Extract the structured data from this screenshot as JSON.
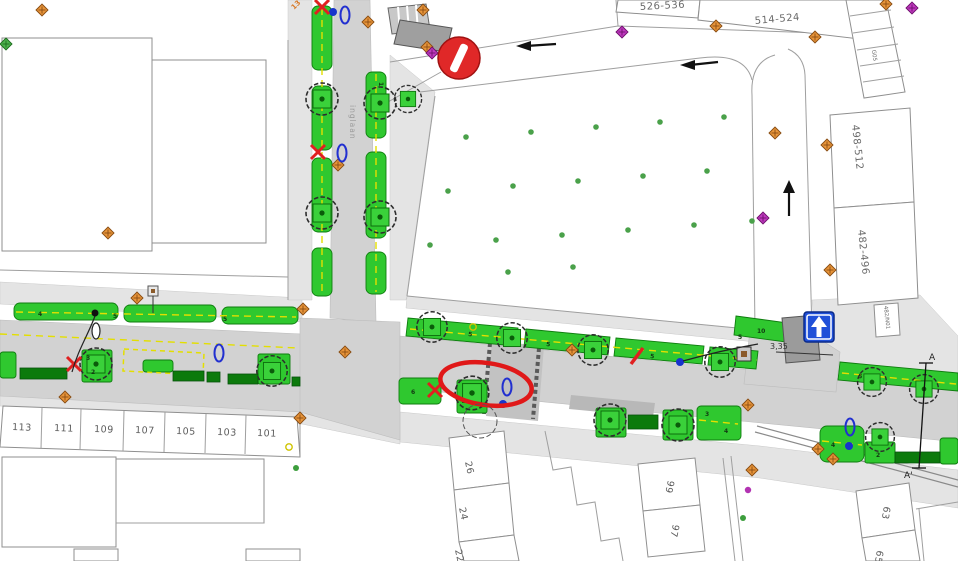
{
  "drawing": {
    "type": "street-redesign-plan",
    "street_label": "inglaan",
    "dimension_label": "3,35",
    "orange_label": "13",
    "section_markers": {
      "start": "A",
      "end": "A'"
    }
  },
  "buildings": {
    "top_right": {
      "b1": "526-536",
      "b2": "514-524",
      "garage": "G05",
      "b3": "498-512",
      "b4": "482-496",
      "b5": "482/N01"
    },
    "left_row": [
      "113",
      "111",
      "109",
      "107",
      "105",
      "103",
      "101"
    ],
    "center_row": [
      "26",
      "24",
      "22"
    ],
    "right_row": [
      "99",
      "97"
    ],
    "far_right_row": [
      "63",
      "65"
    ]
  },
  "strip_numbers": [
    "4",
    "5",
    "5",
    "1",
    "5",
    "5",
    "5",
    "5",
    "10",
    "5",
    "6",
    "3",
    "2",
    "3",
    "4",
    "4",
    "2"
  ],
  "signs": {
    "no_entry_icon": "no-entry-sign",
    "one_way_icon": "one-way-up-arrow-sign"
  },
  "colors": {
    "green": "#2fc82f",
    "dark_green": "#0c7a0c",
    "road_gray": "#d2d2d2",
    "annotation_red": "#e01818",
    "sign_blue": "#2050d8",
    "marker_orange": "#d97b2a",
    "marker_purple": "#b233b2",
    "dash_yellow": "#e3df00"
  }
}
